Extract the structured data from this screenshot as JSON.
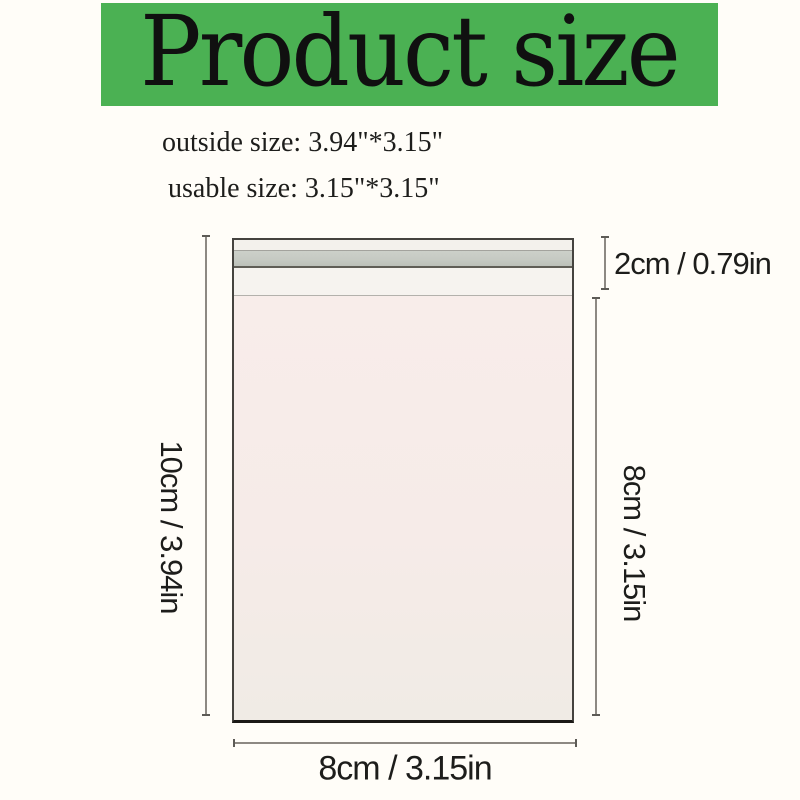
{
  "header": {
    "title": "Product size"
  },
  "specs": {
    "outside": "outside size: 3.94\"*3.15\"",
    "usable": "usable size: 3.15\"*3.15\""
  },
  "diagram": {
    "labels": {
      "flap": "2cm / 0.79in",
      "left_height": "10cm / 3.94in",
      "right_height": "8cm / 3.15in",
      "bottom_width": "8cm / 3.15in"
    }
  },
  "colors": {
    "background": "#fffdf8",
    "banner_green": "#4bb153",
    "title_ink": "#101010",
    "label_ink": "#1d1d1b",
    "bag_body_pink": "#f6ebe8",
    "bag_flap_white": "#f3f1ec",
    "bag_tape_gray": "#c6cac3",
    "bag_fold_white": "#f6f3ef",
    "dimension_line_gray": "#8d8983"
  }
}
